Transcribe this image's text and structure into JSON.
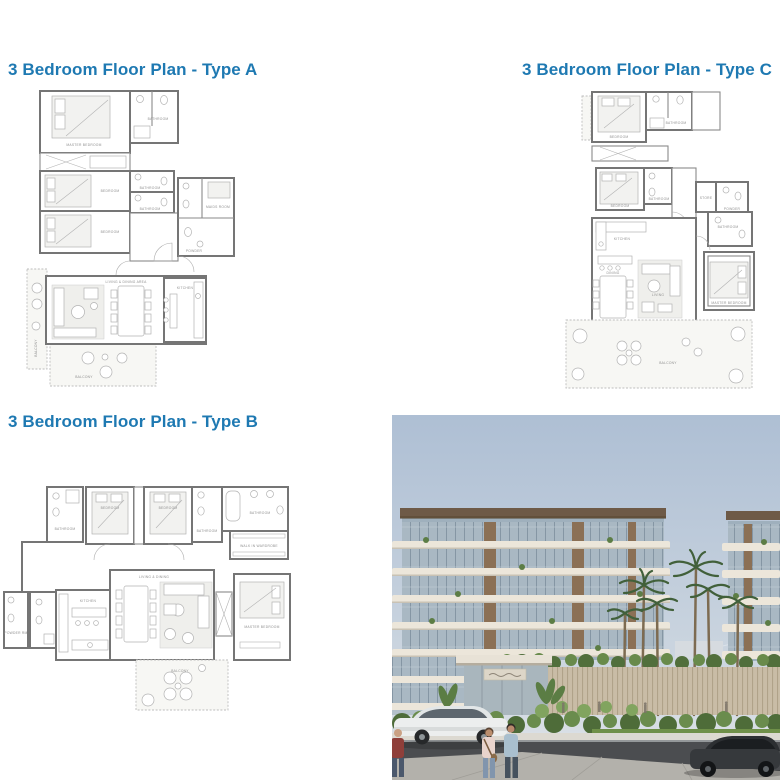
{
  "page": {
    "background": "#ffffff",
    "accent": "#1e79b2"
  },
  "headings": {
    "type_a": "3 Bedroom Floor Plan - Type A",
    "type_b": "3 Bedroom Floor Plan - Type B",
    "type_c": "3 Bedroom Floor Plan - Type C"
  },
  "floorplan_a": {
    "labels": {
      "master_bedroom": "MASTER BEDROOM",
      "bathroom_1": "BATHROOM",
      "bedroom_2": "BEDROOM",
      "bedroom_3": "BEDROOM",
      "bathroom_2": "BATHROOM",
      "bathroom_3": "BATHROOM",
      "maids_room": "MAIDS ROOM",
      "powder": "POWDER",
      "living_dining": "LIVING & DINING AREA",
      "kitchen": "KITCHEN",
      "balcony_left": "BALCONY",
      "balcony_bottom": "BALCONY"
    }
  },
  "floorplan_b": {
    "labels": {
      "bathroom_1": "BATHROOM",
      "bedroom_1": "BEDROOM",
      "bedroom_2": "BEDROOM",
      "bathroom_2": "BATHROOM",
      "bathroom_3": "BATHROOM",
      "walk_in_wardrobe": "WALK IN WARDROBE",
      "powder": "POWDER RM",
      "kitchen": "KITCHEN",
      "living_dining": "LIVING & DINING",
      "master_bedroom": "MASTER BEDROOM",
      "balcony": "BALCONY"
    }
  },
  "floorplan_c": {
    "labels": {
      "bedroom_1": "BEDROOM",
      "bathroom_1": "BATHROOM",
      "bedroom_2": "BEDROOM",
      "bathroom_2": "BATHROOM",
      "store": "STORE",
      "powder": "POWDER",
      "kitchen": "KITCHEN",
      "dining": "DINING",
      "living": "LIVING",
      "bathroom_3": "BATHROOM",
      "master_bedroom": "MASTER BEDROOM",
      "balcony": "BALCONY"
    }
  },
  "photo": {
    "colors": {
      "sky_top": "#aebfd4",
      "sky_bottom": "#e3e6e9",
      "slab": "#ece6da",
      "glass": "#a9b8c3",
      "wood_pier": "#8b7055",
      "roof": "#6e5a47",
      "greenery": "#577540",
      "road": "#4b4d50",
      "sidewalk": "#b3b1ab"
    }
  }
}
